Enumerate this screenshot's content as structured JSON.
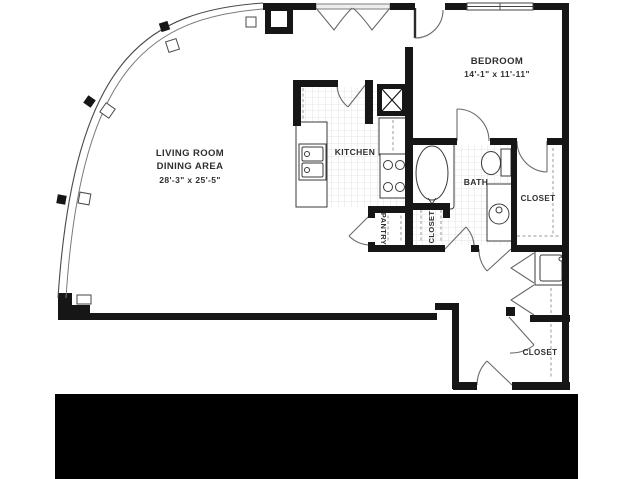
{
  "floor_plan": {
    "rooms": {
      "living_room": {
        "label_line1": "LIVING ROOM",
        "label_line2": "DINING AREA",
        "dimensions": "28'-3\" x 25'-5\""
      },
      "bedroom": {
        "label": "BEDROOM",
        "dimensions": "14'-1\" x 11'-11\""
      },
      "kitchen": {
        "label": "KITCHEN"
      },
      "bath": {
        "label": "BATH"
      },
      "pantry": {
        "label": "PANTRY"
      },
      "bedroom_closet": {
        "label": "CLOSET"
      },
      "linen_closet": {
        "label": "CLOSET"
      },
      "entry_closet": {
        "label": "CLOSET"
      }
    },
    "colors": {
      "wall": "#161616",
      "door_line": "#6a6a6a",
      "tile_line": "#dcdcdc",
      "text": "#2f2f2f",
      "redaction_bar": "#000000",
      "background": "#ffffff"
    }
  }
}
